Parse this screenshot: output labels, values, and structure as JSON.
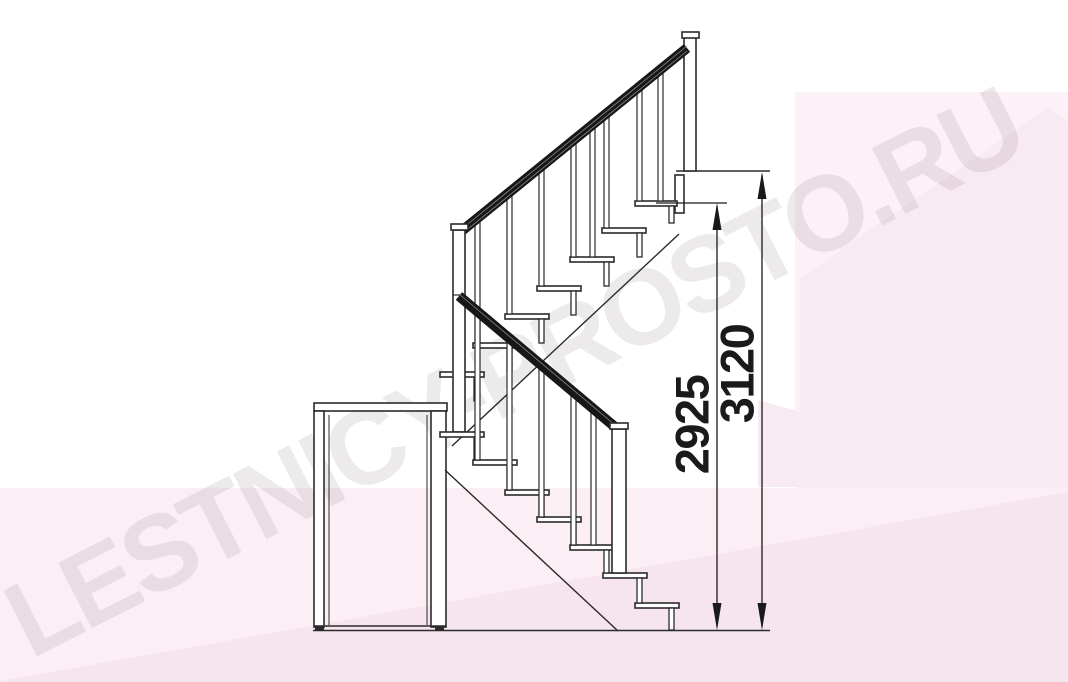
{
  "watermark": {
    "text": "LESTNICY-PROSTO.RU"
  },
  "dimensions": {
    "landing": {
      "value": "2925"
    },
    "total": {
      "value": "3120"
    }
  },
  "colors": {
    "paper": "#ffffff",
    "ink": "#2b2b2b",
    "rail": "#171717",
    "fill_white": "#ffffff",
    "pink_light": "#fcf1f7",
    "pink_mid": "#fbeff5",
    "pink_deep": "#f8eaf2",
    "pink_bottom": "#f6e4ee",
    "watermark_gray": "rgba(141,122,133,0.16)",
    "dim_text": "#1a1a1a"
  }
}
